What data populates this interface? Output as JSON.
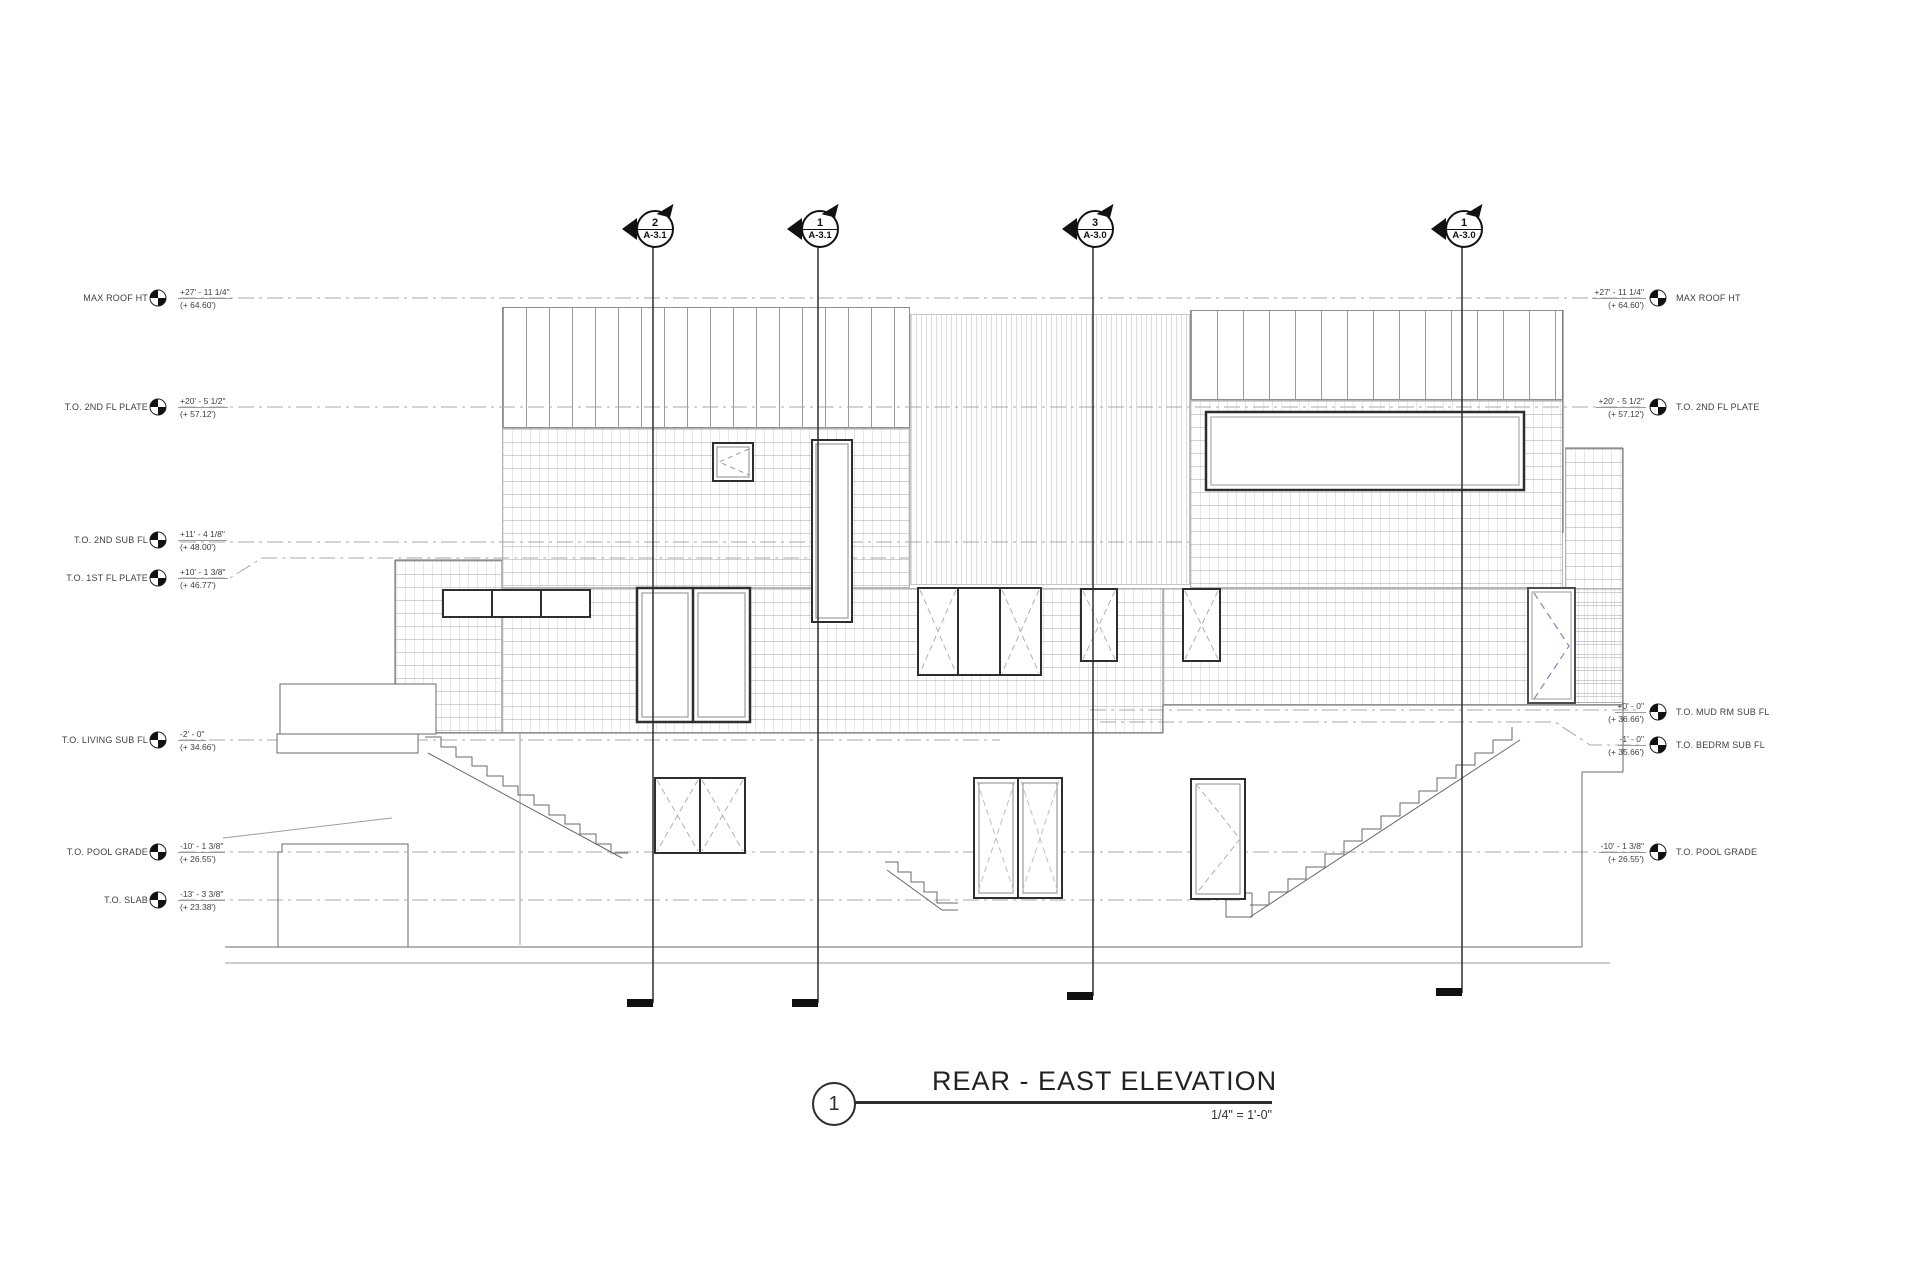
{
  "drawing": {
    "title_number": "1",
    "title": "REAR - EAST ELEVATION",
    "scale": "1/4\" = 1'-0\""
  },
  "section_markers": [
    {
      "number": "2",
      "sheet": "A-3.1"
    },
    {
      "number": "1",
      "sheet": "A-3.1"
    },
    {
      "number": "3",
      "sheet": "A-3.0"
    },
    {
      "number": "1",
      "sheet": "A-3.0"
    }
  ],
  "levels_left": [
    {
      "name": "MAX ROOF HT",
      "dim": "+27' - 11 1/4\"",
      "elev": "(+ 64.60')"
    },
    {
      "name": "T.O. 2ND FL PLATE",
      "dim": "+20' - 5 1/2\"",
      "elev": "(+ 57.12')"
    },
    {
      "name": "T.O. 2ND SUB FL",
      "dim": "+11' - 4 1/8\"",
      "elev": "(+ 48.00')"
    },
    {
      "name": "T.O. 1ST FL PLATE",
      "dim": "+10' - 1 3/8\"",
      "elev": "(+ 46.77')"
    },
    {
      "name": "T.O. LIVING SUB FL",
      "dim": "-2' - 0\"",
      "elev": "(+ 34.66')"
    },
    {
      "name": "T.O. POOL GRADE",
      "dim": "-10' - 1 3/8\"",
      "elev": "(+ 26.55')"
    },
    {
      "name": "T.O. SLAB",
      "dim": "-13' - 3 3/8\"",
      "elev": "(+ 23.38')"
    }
  ],
  "levels_right": [
    {
      "name": "MAX ROOF HT",
      "dim": "+27' - 11 1/4\"",
      "elev": "(+ 64.60')"
    },
    {
      "name": "T.O. 2ND FL PLATE",
      "dim": "+20' - 5 1/2\"",
      "elev": "(+ 57.12')"
    },
    {
      "name": "T.O. MUD RM SUB FL",
      "dim": "+0' - 0\"",
      "elev": "(+ 36.66')"
    },
    {
      "name": "T.O. BEDRM SUB FL",
      "dim": "-1' - 0\"",
      "elev": "(+ 35.66')"
    },
    {
      "name": "T.O. POOL GRADE",
      "dim": "-10' - 1 3/8\"",
      "elev": "(+ 26.55')"
    }
  ],
  "colors": {
    "heavy_line": "#2e2e2e",
    "outline": "#6a6a6a",
    "dash_line": "#a8a8a8",
    "door_swing_accent": "#8585c2"
  }
}
